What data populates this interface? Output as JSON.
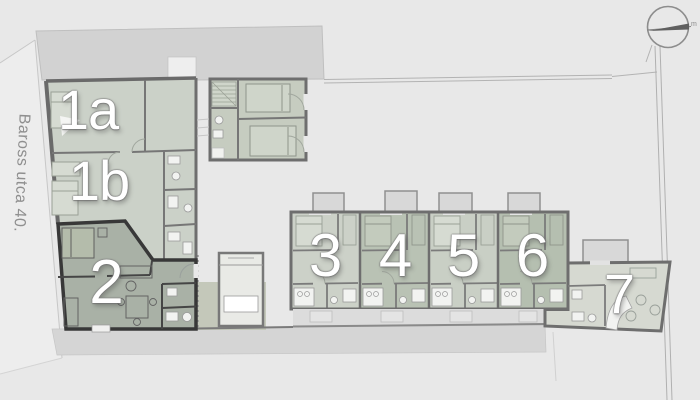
{
  "plan": {
    "street_label": "Baross utca 40.",
    "compass_label": "m",
    "units": [
      {
        "id": "1a",
        "label": "1a"
      },
      {
        "id": "1b",
        "label": "1b"
      },
      {
        "id": "2",
        "label": "2"
      },
      {
        "id": "3",
        "label": "3"
      },
      {
        "id": "4",
        "label": "4"
      },
      {
        "id": "5",
        "label": "5"
      },
      {
        "id": "6",
        "label": "6"
      },
      {
        "id": "7",
        "label": "7"
      }
    ],
    "colors": {
      "background": "#e8e8e8",
      "neighbor_building": "#d2d2d2",
      "unit_fill_light": "#cbd1c8",
      "unit_fill_medium": "#b9c2b4",
      "unit_fill_dark": "#a9b1a6",
      "unit7_fill": "#d6d9d1",
      "wall": "#6e6e6e",
      "wall_bold": "#383838",
      "sidewalk": "#d5d5d5",
      "label_text": "#ffffff",
      "street_text": "#8f8f8f"
    }
  }
}
